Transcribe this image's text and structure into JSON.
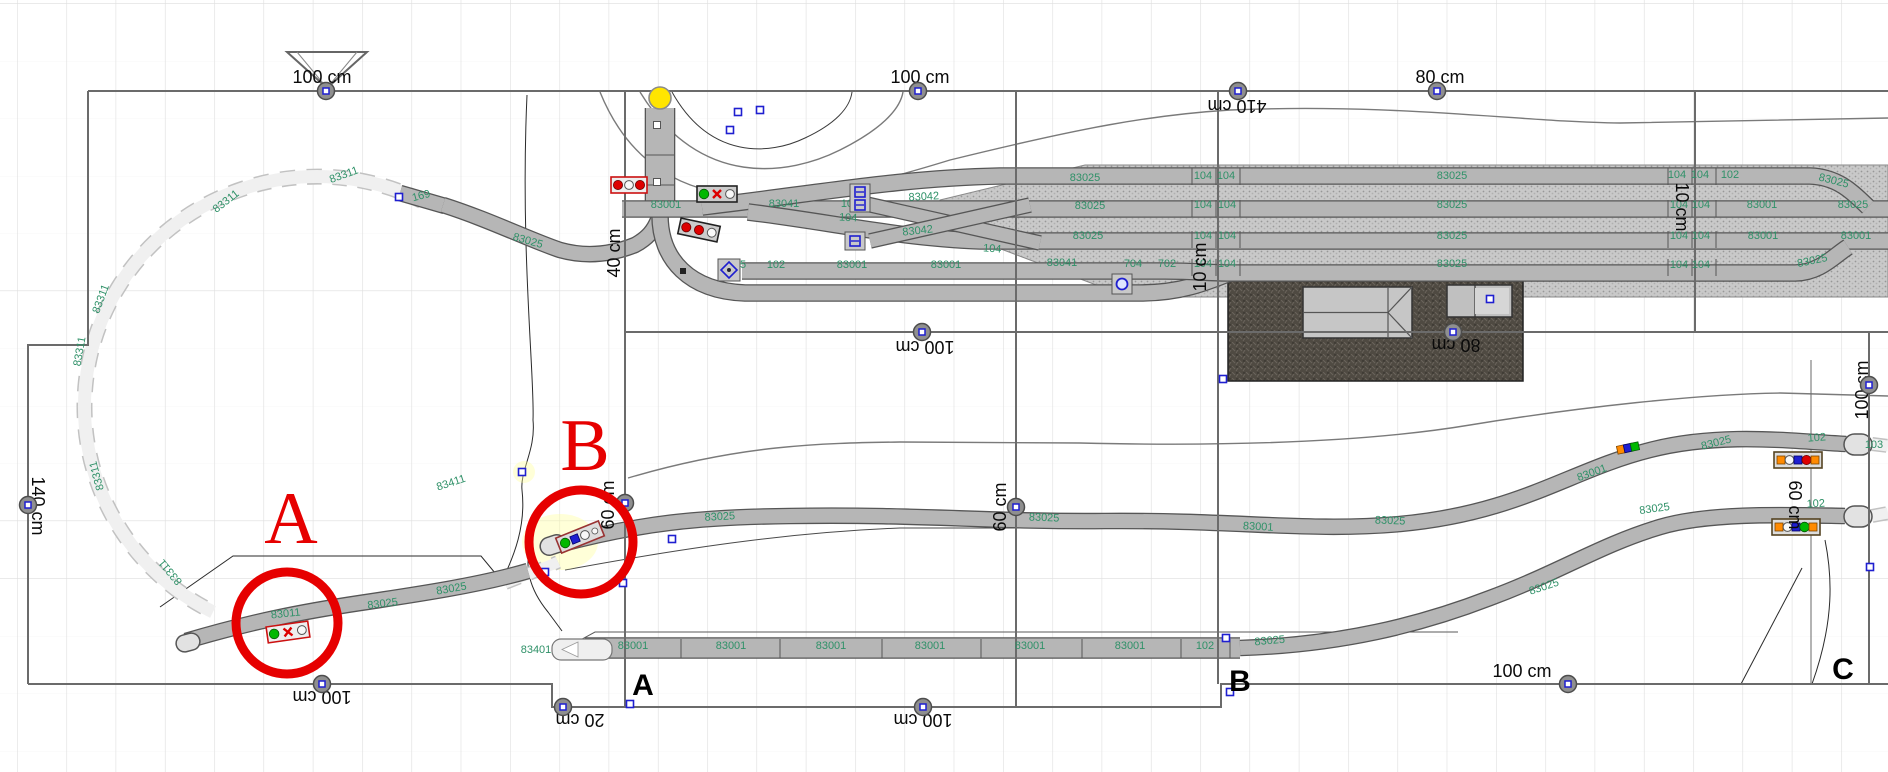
{
  "app": {
    "name": "Model railway track plan editor",
    "view": "layout-canvas"
  },
  "canvas": {
    "w": 1888,
    "h": 772,
    "grid_dx": 49.3,
    "grid_dy": 57.5,
    "grid_ox": 17,
    "grid_oy": 3
  },
  "colors": {
    "grid": "#dedede",
    "track_fill": "#b6b6b6",
    "track_edge": "#565656",
    "phantom_fill": "#f0f0f0",
    "phantom_edge": "#c2c2c2",
    "label_green": "#2f9168",
    "marker_red": "#e60000",
    "ballast": "#c9c9c9",
    "ballast_dot": "#989898",
    "platform": "#4f4a42",
    "platform_dot": "#6a645c",
    "node_fill": "#8f8f8f",
    "handle_blue": "#1f1fd0",
    "yellow": "#ffe500",
    "light_red": "#dd0000",
    "light_green": "#00b800",
    "light_orange": "#ff8a00",
    "light_white": "#f8f8f8"
  },
  "triangle": {
    "points": "287,52 367,52 327,88"
  },
  "yellow_signal": {
    "x": 660,
    "y": 98,
    "r": 11
  },
  "borders": [
    "M88,91 L1888,91",
    "M88,91 L88,345 L28,345 L28,684",
    "M28,684 L552,684 L552,707 L1221,707 L1221,684 L1888,684",
    "M625,91 L625,707",
    "M1016,91 L1016,707",
    "M1218,91 L1218,684",
    "M1695,91 L1695,332",
    "M625,332 L1888,332",
    "M1869,332 L1869,684"
  ],
  "dimensions": [
    [
      "100 cm",
      322,
      77,
      0,
      326,
      91
    ],
    [
      "100 cm",
      920,
      77,
      0,
      918,
      91
    ],
    [
      "410 cm",
      1237,
      106,
      180,
      1238,
      91
    ],
    [
      "80 cm",
      1440,
      77,
      0,
      1437,
      91
    ],
    [
      "40 cm",
      614,
      253,
      -90
    ],
    [
      "140 cm",
      38,
      506,
      90,
      28,
      505
    ],
    [
      "60 cm",
      608,
      505,
      -90,
      625,
      503
    ],
    [
      "60 cm",
      1000,
      507,
      -90,
      1016,
      507
    ],
    [
      "10 cm",
      1200,
      267,
      -90
    ],
    [
      "10 cm",
      1682,
      207,
      90
    ],
    [
      "80 cm",
      1456,
      345,
      180,
      1453,
      332
    ],
    [
      "100 cm",
      925,
      347,
      180,
      922,
      332
    ],
    [
      "100 cm",
      1862,
      390,
      -90,
      1869,
      385
    ],
    [
      "60 cm",
      1795,
      505,
      90
    ],
    [
      "100 cm",
      322,
      697,
      180,
      322,
      684
    ],
    [
      "20 cm",
      580,
      720,
      180,
      563,
      707
    ],
    [
      "100 cm",
      923,
      720,
      180,
      923,
      707
    ],
    [
      "100 cm",
      1522,
      671,
      0,
      1568,
      684
    ]
  ],
  "part_labels": [
    [
      "83311",
      345,
      178,
      -20
    ],
    [
      "83311",
      228,
      204,
      -38
    ],
    [
      "83311",
      104,
      300,
      -70
    ],
    [
      "83311",
      83,
      352,
      -80
    ],
    [
      "83311",
      100,
      475,
      -105
    ],
    [
      "83311",
      173,
      570,
      -130
    ],
    [
      "169",
      422,
      199,
      -15
    ],
    [
      "83025",
      527,
      244,
      16
    ],
    [
      "83001",
      666,
      208,
      0
    ],
    [
      "83041",
      784,
      207,
      0
    ],
    [
      "104",
      850,
      207,
      0
    ],
    [
      "83042",
      924,
      200,
      -3
    ],
    [
      "104",
      848,
      221,
      3
    ],
    [
      "83042",
      918,
      234,
      -6
    ],
    [
      "104",
      992,
      252,
      4
    ],
    [
      "95",
      740,
      268,
      0
    ],
    [
      "102",
      776,
      268,
      0
    ],
    [
      "83001",
      852,
      268,
      0
    ],
    [
      "83001",
      946,
      268,
      0
    ],
    [
      "83041",
      1062,
      266,
      0
    ],
    [
      "83025",
      1085,
      181,
      0
    ],
    [
      "104",
      1203,
      179,
      0
    ],
    [
      "104",
      1226,
      179,
      0
    ],
    [
      "83025",
      1452,
      179,
      0
    ],
    [
      "83025",
      1090,
      209,
      0
    ],
    [
      "104",
      1203,
      208,
      0
    ],
    [
      "104",
      1227,
      208,
      0
    ],
    [
      "83025",
      1452,
      208,
      0
    ],
    [
      "83025",
      1088,
      239,
      0
    ],
    [
      "104",
      1203,
      239,
      0
    ],
    [
      "104",
      1227,
      239,
      0
    ],
    [
      "83025",
      1452,
      239,
      0
    ],
    [
      "704",
      1133,
      267,
      0
    ],
    [
      "702",
      1167,
      267,
      0
    ],
    [
      "104",
      1203,
      267,
      0
    ],
    [
      "104",
      1227,
      267,
      0
    ],
    [
      "83025",
      1452,
      267,
      0
    ],
    [
      "104",
      1677,
      178,
      0
    ],
    [
      "104",
      1700,
      178,
      0
    ],
    [
      "102",
      1730,
      178,
      0
    ],
    [
      "83025",
      1833,
      184,
      14
    ],
    [
      "104",
      1679,
      208,
      0
    ],
    [
      "104",
      1701,
      208,
      0
    ],
    [
      "83001",
      1762,
      208,
      0
    ],
    [
      "83025",
      1853,
      208,
      0
    ],
    [
      "104",
      1679,
      239,
      0
    ],
    [
      "104",
      1701,
      239,
      0
    ],
    [
      "83001",
      1763,
      239,
      0
    ],
    [
      "83001",
      1856,
      239,
      0
    ],
    [
      "104",
      1679,
      268,
      0
    ],
    [
      "104",
      1701,
      268,
      0
    ],
    [
      "83025",
      1813,
      264,
      -12
    ],
    [
      "83001",
      633,
      649,
      0
    ],
    [
      "83001",
      731,
      649,
      0
    ],
    [
      "83001",
      831,
      649,
      0
    ],
    [
      "83001",
      930,
      649,
      0
    ],
    [
      "83001",
      1030,
      649,
      0
    ],
    [
      "83001",
      1130,
      649,
      0
    ],
    [
      "102",
      1205,
      649,
      0
    ],
    [
      "83401",
      536,
      653,
      0
    ],
    [
      "83025",
      1270,
      644,
      -5
    ],
    [
      "83011",
      286,
      617,
      -6
    ],
    [
      "83025",
      383,
      607,
      -7
    ],
    [
      "83025",
      452,
      592,
      -10
    ],
    [
      "83411",
      452,
      486,
      -18
    ],
    [
      "83025",
      720,
      520,
      -3
    ],
    [
      "83025",
      1044,
      521,
      2
    ],
    [
      "83001",
      1258,
      530,
      3
    ],
    [
      "83025",
      1390,
      524,
      2
    ],
    [
      "83025",
      1717,
      446,
      -14
    ],
    [
      "102",
      1817,
      441,
      -4
    ],
    [
      "103",
      1874,
      448,
      0
    ],
    [
      "83001",
      1593,
      476,
      -20
    ],
    [
      "83025",
      1655,
      512,
      -8
    ],
    [
      "102",
      1816,
      507,
      -3
    ],
    [
      "83025",
      1545,
      590,
      -18
    ]
  ],
  "tracks": [
    {
      "d": "M422,201 A225,222 0 1 0 213,612",
      "w": 13,
      "kind": "phantom"
    },
    {
      "d": "M505,583 C525,575 545,568 558,562",
      "w": 11,
      "kind": "phantom"
    },
    {
      "d": "M1872,444 L1888,446",
      "w": 11,
      "kind": "phantom"
    },
    {
      "d": "M1872,516 L1888,513",
      "w": 11,
      "kind": "phantom"
    },
    {
      "d": "M400,193 L445,206",
      "w": 14,
      "kind": "solid"
    },
    {
      "d": "M443,205 C490,220 530,240 560,250 C585,257 610,255 635,245 C648,238 654,230 658,220",
      "w": 14,
      "kind": "solid"
    },
    {
      "d": "M660,108 L660,215",
      "w": 28,
      "kind": "solid"
    },
    {
      "d": "M660,215 C660,260 690,291 745,293 L1140,293 C1180,293 1205,283 1230,273",
      "w": 15,
      "kind": "solid"
    },
    {
      "d": "M622,209 L1888,209",
      "w": 15,
      "kind": "solid"
    },
    {
      "d": "M702,207 C820,193 900,178 1000,176 L1810,176 C1840,177 1855,195 1868,207",
      "w": 15,
      "kind": "solid"
    },
    {
      "d": "M748,212 C830,222 900,238 980,241 L1888,241",
      "w": 15,
      "kind": "solid"
    },
    {
      "d": "M1230,273 L1795,273 C1820,273 1835,255 1848,247",
      "w": 15,
      "kind": "solid"
    },
    {
      "d": "M742,271 L1165,271 C1195,271 1210,273 1230,273",
      "w": 15,
      "kind": "solid"
    },
    {
      "d": "M862,203 L1040,243",
      "w": 13,
      "kind": "solid"
    },
    {
      "d": "M870,241 L1030,205",
      "w": 13,
      "kind": "solid"
    },
    {
      "d": "M186,641 C250,622 300,612 360,603 C420,594 480,585 528,571",
      "w": 14,
      "kind": "solid"
    },
    {
      "d": "M558,545 C640,523 700,517 790,516 C920,514 990,522 1105,521 C1240,520 1310,532 1400,524 C1520,513 1570,470 1650,450 C1720,432 1790,441 1846,444",
      "w": 14,
      "kind": "solid"
    },
    {
      "d": "M585,648 L1240,648",
      "w": 19,
      "kind": "solid"
    },
    {
      "d": "M1240,648 C1340,645 1420,625 1490,598 C1560,572 1600,545 1660,527 C1710,512 1790,515 1845,516",
      "w": 14,
      "kind": "solid"
    }
  ],
  "tick_groups": [
    {
      "xs": [
        1192,
        1216,
        1240,
        1668,
        1692,
        1716
      ],
      "rows": [
        [
          168,
          185
        ],
        [
          200,
          217
        ],
        [
          231,
          248
        ],
        [
          259,
          276
        ]
      ]
    },
    {
      "xs": [
        681,
        780,
        882,
        981,
        1082,
        1181,
        1230
      ],
      "rows": [
        [
          639,
          658
        ]
      ]
    }
  ],
  "contours": [
    {
      "d": "M640,92 C700,190 790,175 840,150 C880,130 900,110 903,92",
      "c": "#7a7a7a",
      "w": 1.4
    },
    {
      "d": "M672,92 C710,160 770,155 805,138 C835,124 850,108 852,92",
      "c": "#3a3a3a",
      "w": 1
    },
    {
      "d": "M600,92 C660,240 820,200 950,160 C1080,128 1150,115 1230,110 C1400,103 1520,122 1620,123 L1888,118",
      "c": "#7a7a7a",
      "w": 1.4
    },
    {
      "d": "M527,95 C520,250 535,380 533,420 C536,450 520,470 522,490 C526,525 515,555 500,585",
      "c": "#2a2a2a",
      "w": 1
    },
    {
      "d": "M628,478 C740,445 820,443 900,442 L1080,443 C1250,447 1380,440 1470,425 C1580,407 1700,394 1780,393 L1888,396",
      "c": "#7a7a7a",
      "w": 1.4
    },
    {
      "d": "M565,570 C700,545 800,532 900,528 L1150,528",
      "c": "#4a4a4a",
      "w": 1
    },
    {
      "d": "M1490,505 L1648,450",
      "c": "#4a4a4a",
      "w": 1
    },
    {
      "d": "M1741,684 L1802,568",
      "c": "#2a2a2a",
      "w": 1
    },
    {
      "d": "M1812,684 C1835,620 1832,575 1825,540",
      "c": "#2a2a2a",
      "w": 1
    },
    {
      "d": "M1811,360 L1811,684",
      "c": "#6a6a6a",
      "w": 1
    },
    {
      "d": "M160,607 L233,556 L481,556 L505,585",
      "c": "#2a2a2a",
      "w": 1
    },
    {
      "d": "M533,540 C522,565 530,590 548,612 L562,631",
      "c": "#2a2a2a",
      "w": 1
    },
    {
      "d": "M575,643 L595,632 L1458,632",
      "c": "#5a5a5a",
      "w": 1
    }
  ],
  "ballast_poly": "940,200 1085,165 1888,165 1888,297 1128,297 940,226",
  "platform": {
    "x": 1228,
    "y": 278,
    "w": 295,
    "h": 103
  },
  "buildings": {
    "main": {
      "x": 1303,
      "y": 287,
      "w": 109,
      "h": 51,
      "ridge_x2": 1388
    },
    "annex": {
      "x": 1447,
      "y": 285,
      "w": 65,
      "h": 32,
      "divider_x": 1475
    }
  },
  "white_crossing": {
    "x": 552,
    "y": 639,
    "w": 60,
    "h": 21
  },
  "end_caps": [
    {
      "x": 1844,
      "y": 434,
      "w": 28,
      "h": 21,
      "r": 0
    },
    {
      "x": 1844,
      "y": 506,
      "w": 28,
      "h": 21,
      "r": 0
    },
    {
      "x": 540,
      "y": 536,
      "w": 26,
      "h": 18,
      "r": -18
    },
    {
      "x": 176,
      "y": 634,
      "w": 24,
      "h": 17,
      "r": -15
    }
  ],
  "signals": [
    {
      "x": 288,
      "y": 632,
      "r": -8,
      "w": 42,
      "h": 16,
      "f": "#cc1111",
      "b": "#eeeeee",
      "L": [
        "G",
        "RX",
        "W"
      ]
    },
    {
      "x": 580,
      "y": 537,
      "r": -22,
      "w": 46,
      "h": 16,
      "f": "#993333",
      "b": "#dddddd",
      "L": [
        "G",
        "BX",
        "W",
        "w"
      ]
    },
    {
      "x": 629,
      "y": 185,
      "r": 0,
      "w": 36,
      "h": 16,
      "f": "#cc1111",
      "b": "#eeeeee",
      "L": [
        "R",
        "W",
        "R"
      ]
    },
    {
      "x": 717,
      "y": 194,
      "r": 0,
      "w": 40,
      "h": 16,
      "f": "#222222",
      "b": "#cccccc",
      "L": [
        "G",
        "RX",
        "W"
      ]
    },
    {
      "x": 699,
      "y": 230,
      "r": 12,
      "w": 40,
      "h": 16,
      "f": "#222222",
      "b": "#cccccc",
      "L": [
        "R",
        "R",
        "W"
      ]
    },
    {
      "x": 1628,
      "y": 448,
      "r": -12,
      "w": 28,
      "h": 10,
      "f": "none",
      "b": "none",
      "L": [
        "O",
        "BX",
        "GS"
      ]
    },
    {
      "x": 1798,
      "y": 460,
      "r": 0,
      "w": 48,
      "h": 16,
      "f": "#554422",
      "b": "#dddddd",
      "L": [
        "O",
        "W",
        "BX",
        "R",
        "O"
      ]
    },
    {
      "x": 1796,
      "y": 527,
      "r": 0,
      "w": 48,
      "h": 16,
      "f": "#554422",
      "b": "#dddddd",
      "L": [
        "O",
        "W",
        "BX",
        "G",
        "O"
      ]
    }
  ],
  "icons": [
    {
      "type": "diamond",
      "x": 729,
      "y": 270
    },
    {
      "type": "swpair",
      "x": 860,
      "y": 198
    },
    {
      "type": "swone",
      "x": 855,
      "y": 241
    },
    {
      "type": "swcircle",
      "x": 1122,
      "y": 284
    }
  ],
  "handles": [
    [
      399,
      197
    ],
    [
      738,
      112
    ],
    [
      760,
      110
    ],
    [
      730,
      130
    ],
    [
      672,
      539
    ],
    [
      623,
      583
    ],
    [
      545,
      572
    ],
    [
      522,
      472
    ],
    [
      1490,
      299
    ],
    [
      1223,
      379
    ],
    [
      1870,
      567
    ],
    [
      630,
      704
    ],
    [
      1226,
      638
    ],
    [
      1230,
      692
    ]
  ],
  "dots": [
    [
      683,
      271
    ]
  ],
  "highlights": [
    {
      "x": 560,
      "y": 542,
      "rx": 38,
      "ry": 28
    },
    {
      "x": 524,
      "y": 472,
      "rx": 11,
      "ry": 11
    }
  ],
  "zones": [
    {
      "letter": "A",
      "cx": 287,
      "cy": 623,
      "rad": 51,
      "lx": 291,
      "ly": 543
    },
    {
      "letter": "B",
      "cx": 581,
      "cy": 542,
      "rad": 52,
      "lx": 585,
      "ly": 470
    }
  ],
  "bottom_markers": [
    {
      "t": "A",
      "x": 643,
      "y": 695
    },
    {
      "t": "B",
      "x": 1240,
      "y": 691
    },
    {
      "t": "C",
      "x": 1843,
      "y": 679
    }
  ]
}
